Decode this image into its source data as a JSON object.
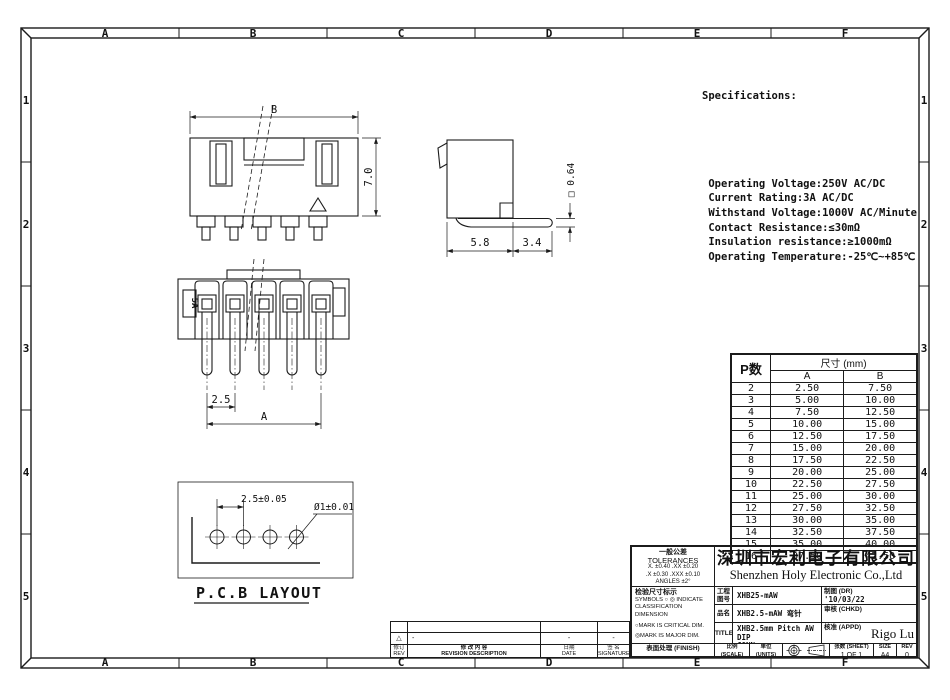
{
  "sheet": {
    "grid_cols": [
      "A",
      "B",
      "C",
      "D",
      "E",
      "F"
    ],
    "grid_rows": [
      "1",
      "2",
      "3",
      "4",
      "5"
    ]
  },
  "specifications": {
    "title": "Specifications:",
    "lines": [
      " Operating Voltage:250V AC/DC",
      " Current Rating:3A AC/DC",
      " Withstand Voltage:1000V AC/Minute",
      " Contact Resistance:≤30mΩ",
      " Insulation resistance:≥1000mΩ",
      " Operating Temperature:-25℃~+85℃"
    ]
  },
  "views": {
    "front": {
      "dim_width": "B",
      "dim_height": "7.0"
    },
    "side": {
      "dim_body": "5.8",
      "dim_pin": "3.4",
      "dim_pin_size": "□ 0.64"
    },
    "pin": {
      "marking": "5A",
      "dim_pitch": "2.5",
      "dim_span": "A"
    },
    "pcb": {
      "dim_pitch": "2.5±0.05",
      "dim_hole": "Ø1±0.01",
      "label": "P.C.B LAYOUT"
    }
  },
  "size_table": {
    "header_p": "P数",
    "header_size": "尺寸 (mm)",
    "col_a": "A",
    "col_b": "B",
    "rows": [
      {
        "p": "2",
        "a": "2.50",
        "b": "7.50"
      },
      {
        "p": "3",
        "a": "5.00",
        "b": "10.00"
      },
      {
        "p": "4",
        "a": "7.50",
        "b": "12.50"
      },
      {
        "p": "5",
        "a": "10.00",
        "b": "15.00"
      },
      {
        "p": "6",
        "a": "12.50",
        "b": "17.50"
      },
      {
        "p": "7",
        "a": "15.00",
        "b": "20.00"
      },
      {
        "p": "8",
        "a": "17.50",
        "b": "22.50"
      },
      {
        "p": "9",
        "a": "20.00",
        "b": "25.00"
      },
      {
        "p": "10",
        "a": "22.50",
        "b": "27.50"
      },
      {
        "p": "11",
        "a": "25.00",
        "b": "30.00"
      },
      {
        "p": "12",
        "a": "27.50",
        "b": "32.50"
      },
      {
        "p": "13",
        "a": "30.00",
        "b": "35.00"
      },
      {
        "p": "14",
        "a": "32.50",
        "b": "37.50"
      },
      {
        "p": "15",
        "a": "35.00",
        "b": "40.00"
      },
      {
        "p": "16",
        "a": "37.50",
        "b": "42.50"
      }
    ]
  },
  "title_block": {
    "tolerances": {
      "title_cn": "一般公差",
      "title_en": "TOLERANCES",
      "line1": "X. ±0.40    .XX ±0.20",
      "line2": ".X ±0.30   .XXX ±0.10",
      "line3": "ANGLES    ±2°"
    },
    "symbols": {
      "title_cn": "检验尺寸标示",
      "line1": "SYMBOLS ○ ◎ INDICATE",
      "line2": "CLASSIFICATION DIMENSION",
      "line3": "○MARK IS CRITICAL DIM.",
      "line4": "◎MARK IS MAJOR DIM."
    },
    "finish_label": "表面处理 (FINISH)",
    "company_cn": "深圳市宏利电子有限公司",
    "company_en": "Shenzhen Holy Electronic Co.,Ltd",
    "part_no_label": "工程\n图号",
    "part_no": "XHB25-mAW",
    "name_label": "品名",
    "name": "XHB2.5-mAW 弯针",
    "title_label": "TITLE",
    "title": "XHB2.5mm Pitch AW DIP\nCONN",
    "drawn_label": "制图 (DR)",
    "drawn": "'10/03/22",
    "checked_label": "审核 (CHKD)",
    "approved_label": "核准 (APPD)",
    "approved": "Rigo Lu",
    "scale_label": "比例 (SCALE)",
    "scale": "1:1",
    "units_label": "单位 (UNITS)",
    "units": "mm",
    "sheet_label": "张数 (SHEET)",
    "sheet": "1 OF 1",
    "size_label": "SIZE",
    "size": "A4",
    "rev_label": "REV",
    "rev": "0"
  },
  "revision_block": {
    "rev_symbol": "△",
    "desc_value": "-",
    "date_value": "-",
    "sig_value": "-",
    "rev_label": "修订\nREV",
    "desc_label": "修 改 内 容\nREVISION DESCRIPTION",
    "date_label": "日期\nDATE",
    "sig_label": "签 名\nSIGNATURE"
  }
}
